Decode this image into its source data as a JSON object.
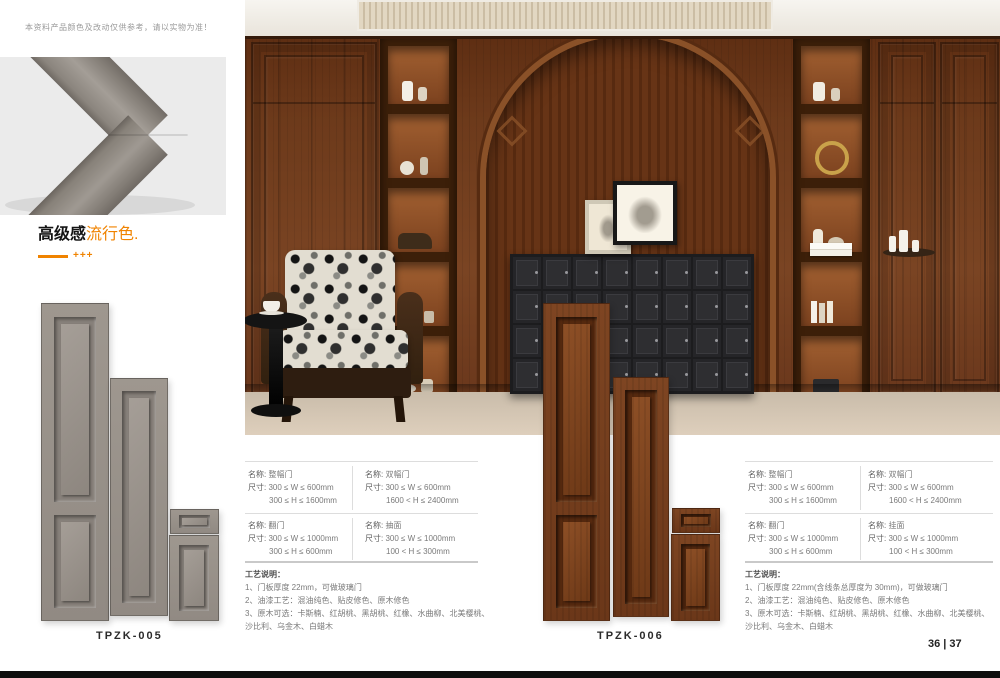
{
  "page": {
    "disclaimer": "本资料产品颜色及改动仅供参考，请以实物为准！",
    "page_number": "36 | 37"
  },
  "heading": {
    "title_black": "高级感",
    "title_orange": "流行色",
    "dot": ".",
    "accent_marks": "+++"
  },
  "colors": {
    "accent_orange": "#f08300",
    "gray_door": "#97908a",
    "wood_door": "#7a431f",
    "cabinet_dark": "#2e2e31",
    "floor": "#d5c9b8"
  },
  "products": [
    {
      "code": "TPZK-005",
      "finish": "gray"
    },
    {
      "code": "TPZK-006",
      "finish": "wood"
    }
  ],
  "specs": [
    {
      "rows": [
        {
          "cells": [
            {
              "name_label": "名称:",
              "name": "整幅门",
              "size_label": "尺寸:",
              "size1": "300 ≤ W ≤ 600mm",
              "size2": "300 ≤ H ≤ 1600mm"
            },
            {
              "name_label": "名称:",
              "name": "双幅门",
              "size_label": "尺寸:",
              "size1": "300 ≤ W ≤ 600mm",
              "size2": "1600 < H ≤ 2400mm"
            }
          ]
        },
        {
          "cells": [
            {
              "name_label": "名称:",
              "name": "翻门",
              "size_label": "尺寸:",
              "size1": "300 ≤ W ≤ 1000mm",
              "size2": "300 ≤ H ≤ 600mm"
            },
            {
              "name_label": "名称:",
              "name": "抽面",
              "size_label": "尺寸:",
              "size1": "300 ≤ W ≤ 1000mm",
              "size2": "100 < H ≤ 300mm"
            }
          ]
        }
      ],
      "notes_title": "工艺说明：",
      "notes_1": "1、门板厚度 22mm，可做玻璃门",
      "notes_2": "2、油漆工艺：混油纯色、贴皮修色、原木修色",
      "notes_3": "3、原木可选：卡斯楠、红胡桃、黑胡桃、红橡、水曲柳、北美樱桃、沙比利、乌金木、白蜡木"
    },
    {
      "rows": [
        {
          "cells": [
            {
              "name_label": "名称:",
              "name": "整幅门",
              "size_label": "尺寸:",
              "size1": "300 ≤ W ≤ 600mm",
              "size2": "300 ≤ H ≤ 1600mm"
            },
            {
              "name_label": "名称:",
              "name": "双幅门",
              "size_label": "尺寸:",
              "size1": "300 ≤ W ≤ 600mm",
              "size2": "1600 < H ≤ 2400mm"
            }
          ]
        },
        {
          "cells": [
            {
              "name_label": "名称:",
              "name": "翻门",
              "size_label": "尺寸:",
              "size1": "300 ≤ W ≤ 1000mm",
              "size2": "300 ≤ H ≤ 600mm"
            },
            {
              "name_label": "名称:",
              "name": "挂面",
              "size_label": "尺寸:",
              "size1": "300 ≤ W ≤ 1000mm",
              "size2": "100 < H ≤ 300mm"
            }
          ]
        }
      ],
      "notes_title": "工艺说明：",
      "notes_1": "1、门板厚度 22mm(含线条总厚度为 30mm)，可做玻璃门",
      "notes_2": "2、油漆工艺：混油纯色、贴皮修色、原木修色",
      "notes_3": "3、原木可选：卡斯楠、红胡桃、黑胡桃、红橡、水曲柳、北美樱桃、沙比利、乌金木、白蜡木"
    }
  ]
}
